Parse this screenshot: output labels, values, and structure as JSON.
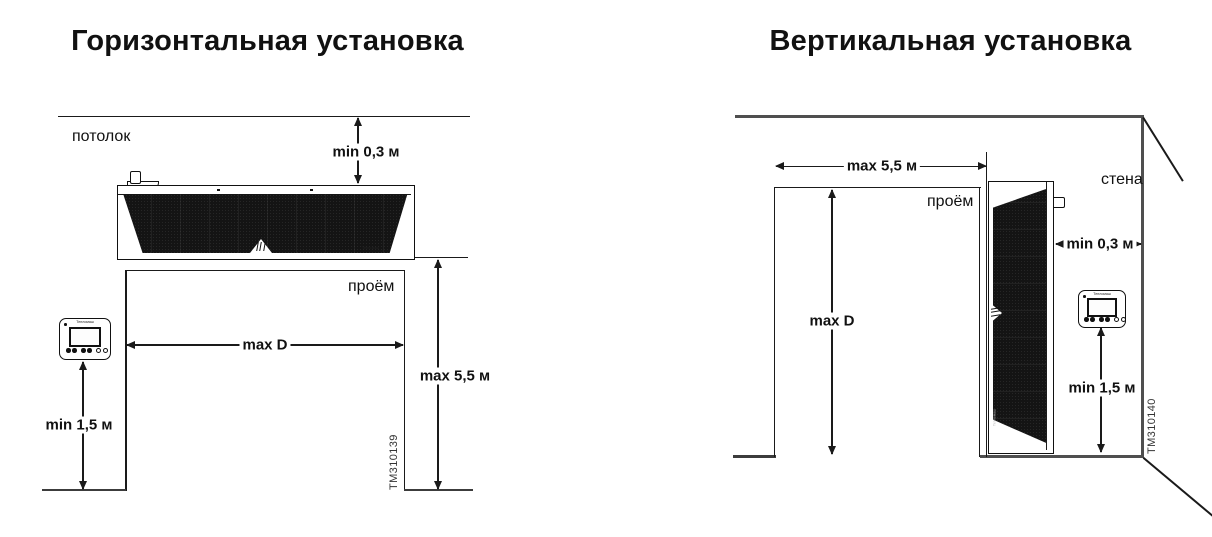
{
  "left": {
    "title": "Горизонтальная установка",
    "labels": {
      "ceiling": "потолок",
      "opening": "проём"
    },
    "dimensions": {
      "ceiling_clearance": "min 0,3 м",
      "opening_width": "max D",
      "opening_height": "max 5,5 м",
      "controller_mount_height": "min 1,5 м"
    },
    "figure_id": "TM310139",
    "unit_brand_label": "Тепломаш",
    "remote_brand_label": "Тепломаш"
  },
  "right": {
    "title": "Вертикальная установка",
    "labels": {
      "wall": "стена",
      "opening": "проём"
    },
    "dimensions": {
      "opening_width": "max 5,5 м",
      "opening_height": "max D",
      "wall_clearance": "min 0,3 м",
      "controller_mount_height": "min 1,5 м"
    },
    "figure_id": "TM310140",
    "unit_brand_label": "Тепломаш",
    "remote_brand_label": "Тепломаш"
  },
  "colors": {
    "line": "#1a1a1a",
    "wall": "#4f4f4f",
    "grille": "#141414",
    "background": "#ffffff"
  }
}
